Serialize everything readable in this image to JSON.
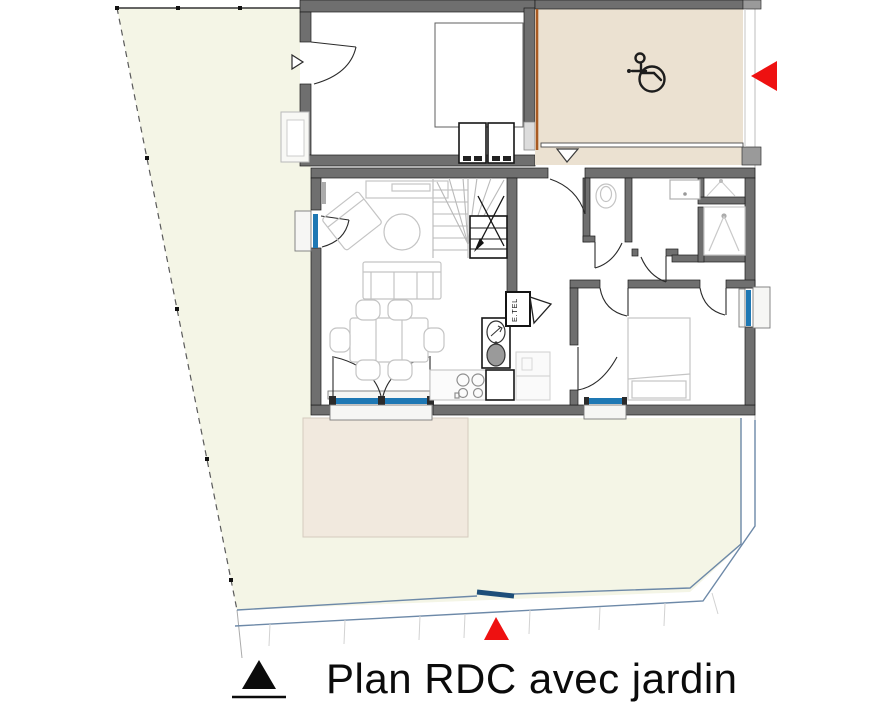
{
  "title": {
    "label": "Plan RDC avec jardin"
  },
  "plan": {
    "etel_label": "E.TEL",
    "icons": {
      "accessibility": "wheelchair-icon",
      "car_entry": "red-triangle-left-icon",
      "pedestrian_entry": "red-triangle-up-icon",
      "garage_door_marker": "white-triangle-right-icon",
      "entrance_door_marker": "white-triangle-down-icon",
      "legend_marker": "black-triangle-icon"
    },
    "colors": {
      "garden": "#f4f5e6",
      "terrace": "#f1e9de",
      "carport": "#ebe1d1",
      "wall": "#6f6f6f",
      "glazing": "#1e78b4",
      "marker_red": "#ee1111",
      "gate_blue": "#1d4e79",
      "boundary_blue": "#6d89a8",
      "wood_edge": "#a85a22",
      "furniture_line": "#c4c4c4"
    }
  }
}
